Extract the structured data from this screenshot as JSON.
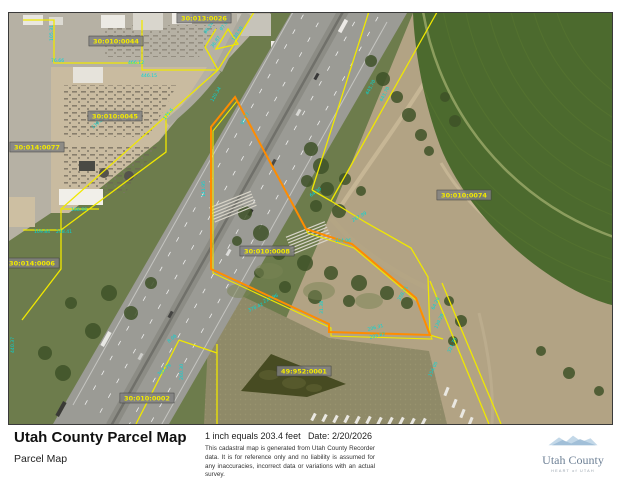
{
  "map": {
    "colors": {
      "selected_parcel": "#ff8c00",
      "parcel_lines": "#f0e800",
      "dimensions": "#00d8d8",
      "label_text": "#f2ea00"
    },
    "parcel_labels": [
      {
        "id": "30:010:0044",
        "x": 115,
        "y": 40
      },
      {
        "id": "30:010:0045",
        "x": 114,
        "y": 115
      },
      {
        "id": "30:014:0077",
        "x": 36,
        "y": 146
      },
      {
        "id": "30:013:0026",
        "x": 203,
        "y": 17
      },
      {
        "id": "30:010:0074",
        "x": 463,
        "y": 194
      },
      {
        "id": "30:010:0008",
        "x": 266,
        "y": 250
      },
      {
        "id": "49:952:0001",
        "x": 303,
        "y": 370
      },
      {
        "id": "30:014:0006",
        "x": 31,
        "y": 262
      },
      {
        "id": "30:010:0002",
        "x": 146,
        "y": 397
      }
    ],
    "dimension_labels": [
      {
        "t": "76.66",
        "x": 50,
        "y": 61,
        "r": 0
      },
      {
        "t": "466.12",
        "x": 127,
        "y": 63,
        "r": 0
      },
      {
        "t": "105.31",
        "x": 52,
        "y": 40,
        "r": -90
      },
      {
        "t": "446.15",
        "x": 140,
        "y": 76,
        "r": 0
      },
      {
        "t": "175.6",
        "x": 164,
        "y": 119,
        "r": -50
      },
      {
        "t": "139.81",
        "x": 92,
        "y": 128,
        "r": -40
      },
      {
        "t": "86.24",
        "x": 205,
        "y": 33,
        "r": -55
      },
      {
        "t": "97.97",
        "x": 221,
        "y": 30,
        "r": -55
      },
      {
        "t": "130.50",
        "x": 233,
        "y": 40,
        "r": -55
      },
      {
        "t": "36.87",
        "x": 212,
        "y": 47,
        "r": -55
      },
      {
        "t": "443.70",
        "x": 367,
        "y": 94,
        "r": -62
      },
      {
        "t": "443.70",
        "x": 381,
        "y": 101,
        "r": -62
      },
      {
        "t": "120.34",
        "x": 212,
        "y": 101,
        "r": -60
      },
      {
        "t": "95.77",
        "x": 242,
        "y": 124,
        "r": -60
      },
      {
        "t": "141.95",
        "x": 204,
        "y": 196,
        "r": -90
      },
      {
        "t": "64.30",
        "x": 310,
        "y": 196,
        "r": -35
      },
      {
        "t": "267.99",
        "x": 352,
        "y": 221,
        "r": -30
      },
      {
        "t": "104.06",
        "x": 334,
        "y": 241,
        "r": 0
      },
      {
        "t": "211.96",
        "x": 263,
        "y": 302,
        "r": -25
      },
      {
        "t": "378.42",
        "x": 248,
        "y": 311,
        "r": -25
      },
      {
        "t": "358.71",
        "x": 399,
        "y": 300,
        "r": -60
      },
      {
        "t": "206.31",
        "x": 367,
        "y": 330,
        "r": -15
      },
      {
        "t": "203.82",
        "x": 369,
        "y": 338,
        "r": -15
      },
      {
        "t": "31.38",
        "x": 322,
        "y": 313,
        "r": -90
      },
      {
        "t": "139.28",
        "x": 436,
        "y": 328,
        "r": -65
      },
      {
        "t": "64.28",
        "x": 433,
        "y": 309,
        "r": -65
      },
      {
        "t": "321.75",
        "x": 449,
        "y": 352,
        "r": -65
      },
      {
        "t": "154.05",
        "x": 430,
        "y": 376,
        "r": -65
      },
      {
        "t": "303.79",
        "x": 158,
        "y": 375,
        "r": -40
      },
      {
        "t": "260.30",
        "x": 182,
        "y": 379,
        "r": -90
      },
      {
        "t": "8.06",
        "x": 168,
        "y": 342,
        "r": -40
      },
      {
        "t": "440.37",
        "x": 13,
        "y": 352,
        "r": -90
      },
      {
        "t": "168.66",
        "x": 70,
        "y": 210,
        "r": 0
      },
      {
        "t": "109.84",
        "x": 33,
        "y": 232,
        "r": 0
      },
      {
        "t": "248.41",
        "x": 55,
        "y": 232,
        "r": 0
      }
    ]
  },
  "footer": {
    "title": "Utah County Parcel Map",
    "subtitle": "Parcel Map",
    "scale_text": "1 inch equals 203.4 feet",
    "date_label": "Date: 2/20/2026",
    "disclaimer": "This cadastral map is generated from Utah County Recorder data.  It is for reference only and no liability is assumed for any inaccuracies, incorrect data or variations with an actual survey.",
    "logo": {
      "name": "Utah County",
      "tagline": "HEART of UTAH"
    }
  }
}
